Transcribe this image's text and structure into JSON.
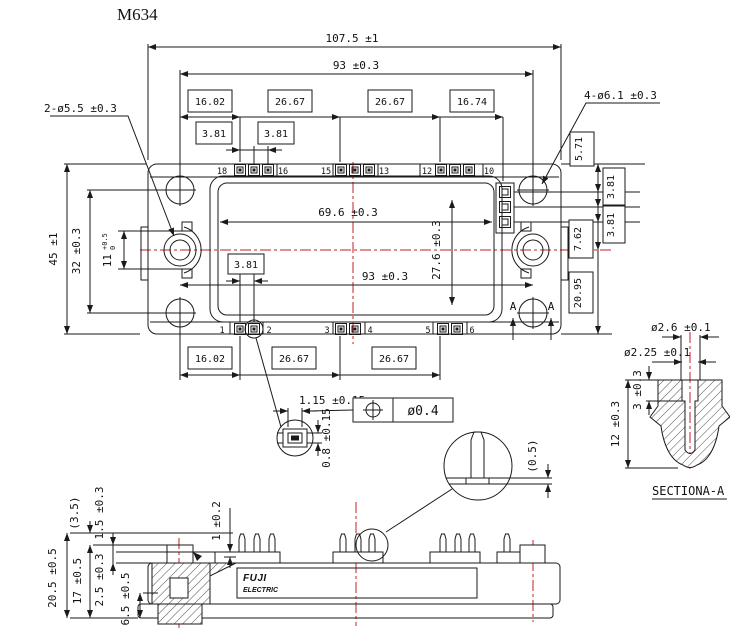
{
  "title": "M634",
  "colors": {
    "line": "#1a1a1a",
    "centerline": "#c22020",
    "background": "#ffffff"
  },
  "top_view": {
    "dim_overall_width": "107.5 ±1",
    "dim_hole_span_top": "93 ±0.3",
    "chain_top": [
      "16.02",
      "26.67",
      "26.67",
      "16.74"
    ],
    "chain_top_sub": [
      "3.81",
      "3.81"
    ],
    "label_left_holes": "2-ø5.5 ±0.3",
    "label_right_holes": "4-ø6.1 ±0.3",
    "dim_overall_height": "45 ±1",
    "dim_hole_span_left": "32 ±0.3",
    "dim_slot": {
      "value": "11",
      "tol_upper": "+0.5",
      "tol_lower": "0"
    },
    "right_chain": [
      "5.71",
      "3.81",
      "3.81",
      "7.62",
      "20.95"
    ],
    "dim_opening_width": "69.6 ±0.3",
    "dim_opening_height": "27.6 ±0.3",
    "dim_hole_span_bottom": "93 ±0.3",
    "dim_pin_pitch": "3.81",
    "chain_bottom": [
      "16.02",
      "26.67",
      "26.67"
    ],
    "pin_numbers_top": [
      "18",
      "16",
      "15",
      "13",
      "12",
      "10"
    ],
    "pin_numbers_bottom": [
      "1",
      "2",
      "3",
      "4",
      "5",
      "6"
    ],
    "section_marker": "A"
  },
  "terminal_detail": {
    "dim_width": "1.15 ±0.15",
    "dim_height": "0.8 ±0.15",
    "position_tolerance": "ø0.4"
  },
  "pin_detail": {
    "dim_standoff": "(0.5)"
  },
  "side_view": {
    "dims": {
      "total_height": "20.5 ±0.5",
      "body_height": "17 ±0.5",
      "pin_protrusion": "(3.5)",
      "step1": "1.5 ±0.3",
      "step2": "2.5 ±0.3",
      "boss_height": "6.5 ±0.5",
      "pedestal": "1 ±0.2"
    },
    "logo_line1": "FUJI",
    "logo_line2": "ELECTRIC"
  },
  "section_aa": {
    "dim_od": "ø2.6 ±0.1",
    "dim_id": "ø2.25 ±0.1",
    "dim_counterbore_depth": "3 ±0.3",
    "dim_depth": "12 ±0.3",
    "caption": "SECTIONA-A"
  }
}
